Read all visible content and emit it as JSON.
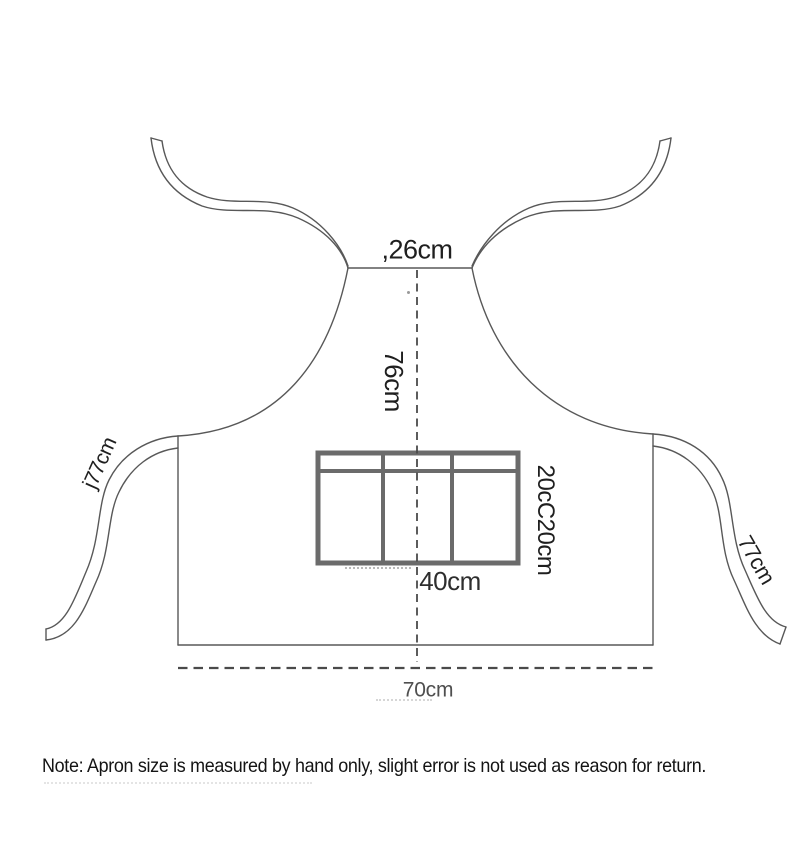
{
  "page": {
    "background": "#ffffff"
  },
  "diagram": {
    "kind": "apron-size-diagram",
    "labels": {
      "neck": {
        "prefix": ",",
        "value": "26cm"
      },
      "bib_length": "76cm",
      "left_strap": {
        "prefix": "j",
        "value": "77cm"
      },
      "right_strap": "77cm",
      "pocket_width": "40cm",
      "pocket_side": "20cC20cm",
      "hem": "70cm"
    },
    "colors": {
      "outline": "#585858",
      "pocket_border": "#6b6b6b",
      "dashed_line": "#4a4a4a",
      "label_dark": "#1f1f1f",
      "label_gray": "#4f4f4f"
    }
  },
  "note": {
    "text": "Note: Apron size is measured by hand only, slight error is not used as reason for return."
  }
}
